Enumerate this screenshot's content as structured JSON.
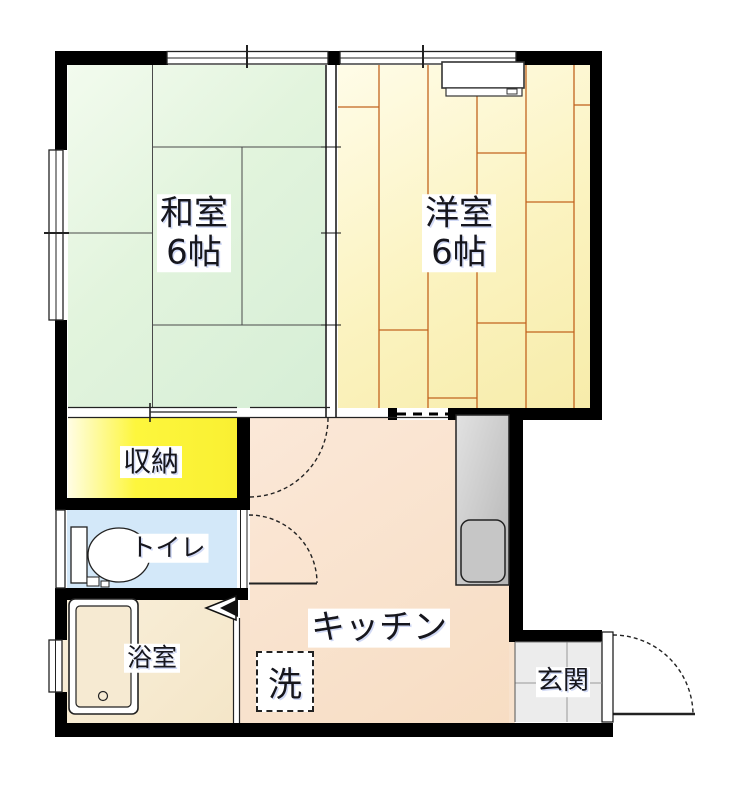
{
  "floor_plan": {
    "rooms": {
      "washitsu": {
        "label": "和室",
        "size": "6帖"
      },
      "youshitsu": {
        "label": "洋室",
        "size": "6帖"
      },
      "closet": {
        "label": "収納"
      },
      "toilet": {
        "label": "トイレ"
      },
      "bathroom": {
        "label": "浴室"
      },
      "kitchen": {
        "label": "キッチン"
      },
      "genkan": {
        "label": "玄関"
      }
    },
    "fixtures": {
      "washing_machine": {
        "label": "洗"
      }
    },
    "colors": {
      "wall": "#000000",
      "washitsu_fill": "#e3f4df",
      "youshitsu_fill": "#fbf2bc",
      "youshitsu_plank_line": "#c2641f",
      "closet_fill": "#fcf63d",
      "toilet_fill": "#d3e8f9",
      "bathroom_fill": "#f6ead2",
      "kitchen_fill": "#f8e2cd",
      "genkan_tile_fill": "#ececec",
      "label_color": "#16161d"
    }
  }
}
